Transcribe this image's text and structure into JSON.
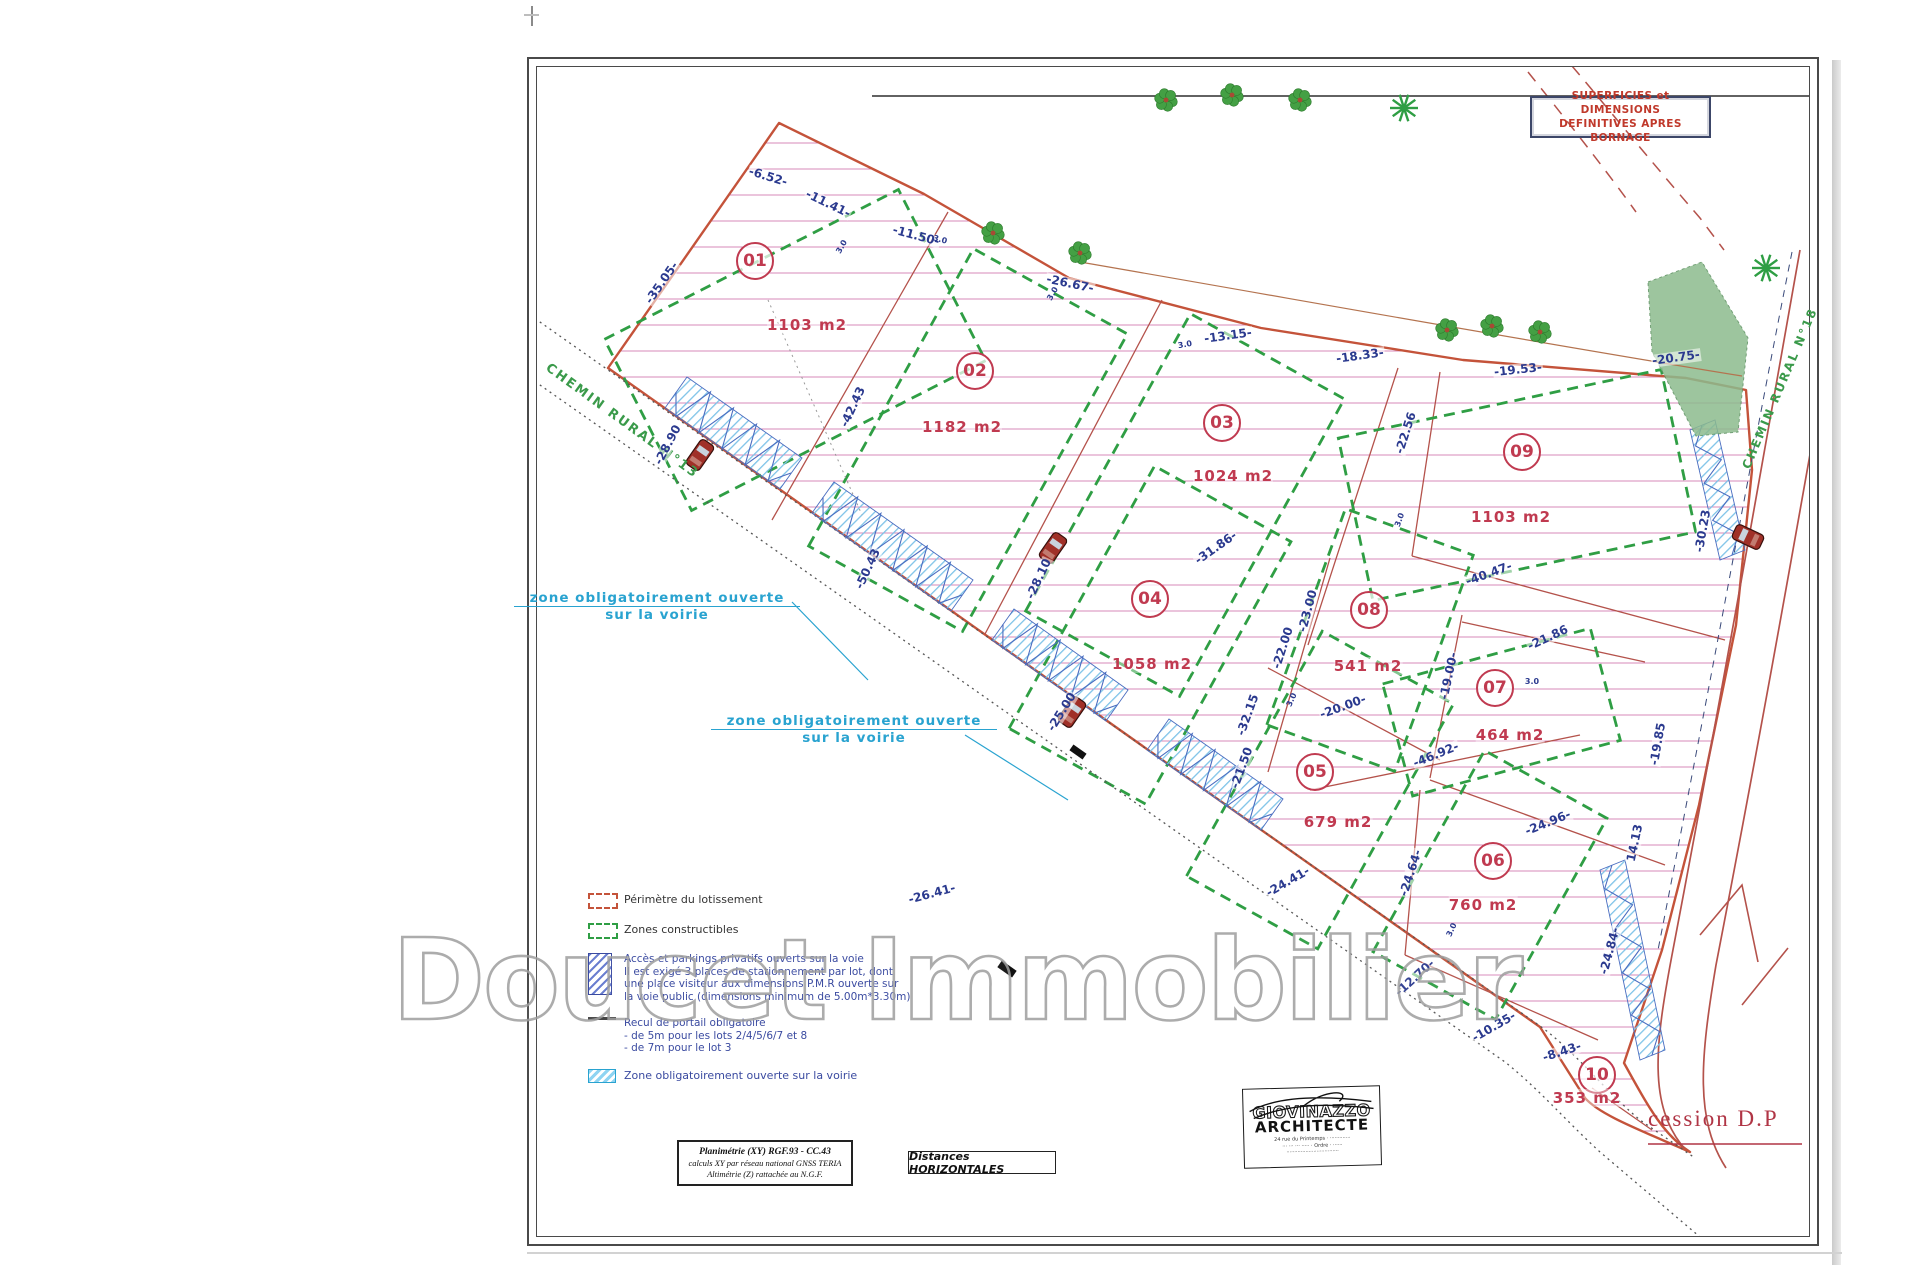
{
  "title_note": {
    "line1": "SUPERFICIES et DIMENSIONS",
    "line2": "DEFINITIVES APRES BORNAGE"
  },
  "watermark": "Doucet Immobilier",
  "roads": {
    "left_label": "CHEMIN RURAL N°13",
    "right_label": "CHEMIN RURAL N°18"
  },
  "open_zone_label": {
    "line1": "zone obligatoirement ouverte",
    "line2": "sur la voirie"
  },
  "lots": [
    {
      "number": "01",
      "area": "1103 m2"
    },
    {
      "number": "02",
      "area": "1182 m2"
    },
    {
      "number": "03",
      "area": "1024 m2"
    },
    {
      "number": "04",
      "area": "1058 m2"
    },
    {
      "number": "05",
      "area": "679 m2"
    },
    {
      "number": "06",
      "area": "760 m2"
    },
    {
      "number": "07",
      "area": "464 m2"
    },
    {
      "number": "08",
      "area": "541 m2"
    },
    {
      "number": "09",
      "area": "1103 m2"
    },
    {
      "number": "10",
      "area": "353 m2"
    }
  ],
  "dimensions": [
    "-6.52-",
    "-11.41-",
    "-11.50-",
    "-26.67-",
    "-35.05-",
    "-28.90",
    "-42.43",
    "-50.43",
    "-28.10",
    "-25.00",
    "-13.15-",
    "-18.33-",
    "-19.53-",
    "-20.75-",
    "-22.56",
    "-31.86-",
    "-40.47-",
    "-23.00",
    "-22.00",
    "-19.00-",
    "-20.00-",
    "-21.86",
    "-32.15",
    "-21.50",
    "-46.92-",
    "-24.96-",
    "-24.64-",
    "-24.41-",
    "-24.84-",
    "14.13",
    "-12.70-",
    "-10.35-",
    "-8.43-",
    "-26.41-",
    "-30.23",
    "-19.85"
  ],
  "small_dim": "3.0",
  "legend": {
    "items": [
      {
        "label": "Périmètre du lotissement"
      },
      {
        "label": "Zones constructibles"
      },
      {
        "label_lines": [
          "Accès et parkings privatifs ouverts sur la voie",
          "Il est exigé 3 places de stationnement par lot, dont",
          "une place visiteur aux dimensions P.M.R ouverte sur",
          "la voie public (dimensions minimum de 5.00m*3.30m)"
        ]
      },
      {
        "label_lines": [
          "Recul de portail obligatoire",
          "- de 5m pour les lots 2/4/5/6/7 et 8",
          "- de 7m pour le lot 3"
        ]
      },
      {
        "label": "Zone obligatoirement ouverte sur la voirie"
      }
    ]
  },
  "survey_box": {
    "line1": "Planimétrie (XY) RGF.93 - CC.43",
    "line2": "calculs XY par réseau national GNSS TERIA",
    "line3": "Altimétrie (Z) rattachée au N.G.F."
  },
  "distances_box": "Distances HORIZONTALES",
  "stamp": {
    "name": "GIOVINAZZO",
    "title": "ARCHITECTE",
    "address_lines": [
      "24 rue du Printemps · ·············",
      "··· ··· ··· ····· · Ordre · ······",
      "·································"
    ]
  },
  "cession_label": "cession D.P",
  "colors": {
    "perimeter": "#c4533a",
    "constructible": "#2f9e44",
    "hatch": "#cd6aa8",
    "dimension": "#2b3a8f",
    "area_text": "#c03a50",
    "open_zone": "#29a3d0",
    "road_label": "#3a9a4a",
    "note_text": "#c0392b"
  }
}
